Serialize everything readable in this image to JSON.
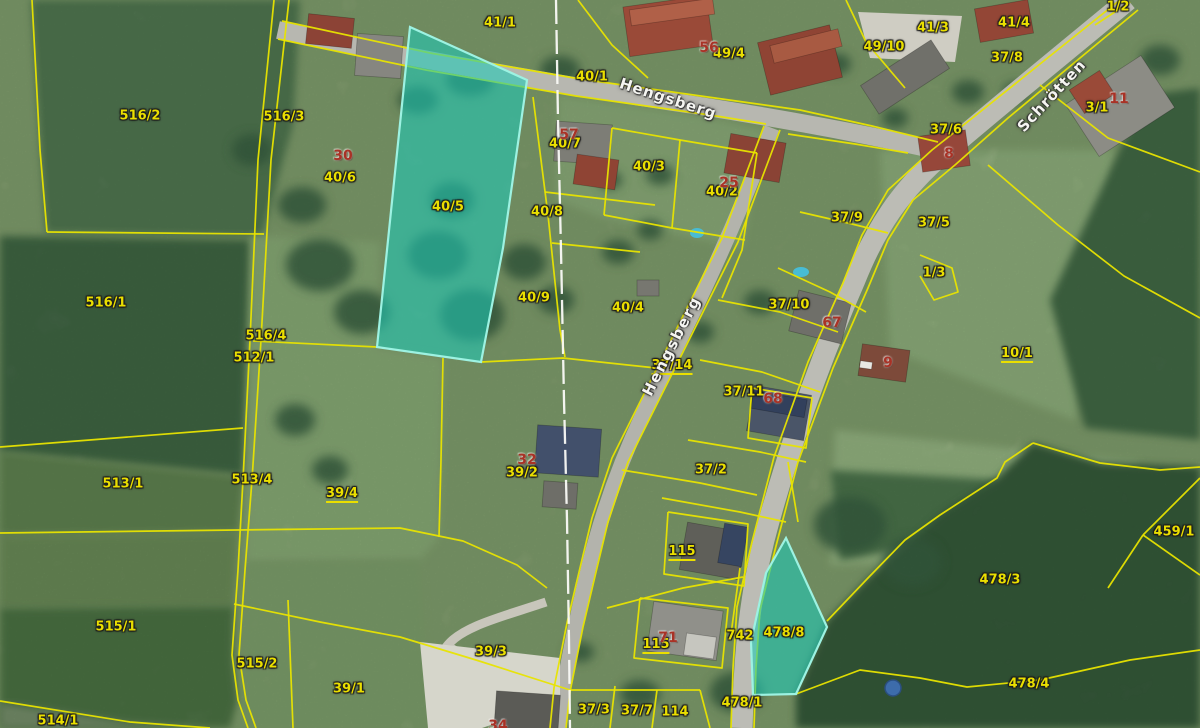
{
  "map": {
    "colors": {
      "parcel_line": "#e8e400",
      "parcel_label": "#eadf00",
      "house_number_label": "#a93226",
      "street_label": "#f5f5f1",
      "highlight_fill": "#1ec9b6",
      "highlight_border": "#9df2e2",
      "municipal_boundary": "#fafaf7"
    },
    "street_labels": [
      {
        "name": "Hengsberg",
        "x": 668,
        "y": 99,
        "rotation": 18,
        "spacing": 1
      },
      {
        "name": "Hengsberg",
        "x": 672,
        "y": 346,
        "rotation": -63,
        "spacing": 2
      },
      {
        "name": "Schrötten",
        "x": 1052,
        "y": 96,
        "rotation": -47,
        "spacing": 1
      }
    ],
    "highlighted_parcels": [
      {
        "id": "40/5",
        "points": "410,27 527,80 503,248 481,362 377,347"
      },
      {
        "id": "478/8",
        "points": "786,538 766,573 751,642 753,695 796,694 827,627"
      }
    ],
    "parcel_labels": [
      {
        "text": "516/2",
        "x": 140,
        "y": 116
      },
      {
        "text": "516/3",
        "x": 284,
        "y": 117
      },
      {
        "text": "40/6",
        "x": 340,
        "y": 178
      },
      {
        "text": "516/1",
        "x": 106,
        "y": 303
      },
      {
        "text": "516/4",
        "x": 266,
        "y": 336
      },
      {
        "text": "512/1",
        "x": 254,
        "y": 358
      },
      {
        "text": "513/1",
        "x": 123,
        "y": 484
      },
      {
        "text": "513/4",
        "x": 252,
        "y": 480
      },
      {
        "text": "39/4",
        "x": 342,
        "y": 495,
        "underline": true
      },
      {
        "text": "515/1",
        "x": 116,
        "y": 627
      },
      {
        "text": "515/2",
        "x": 257,
        "y": 664
      },
      {
        "text": "39/1",
        "x": 349,
        "y": 689
      },
      {
        "text": "514/1",
        "x": 58,
        "y": 721
      },
      {
        "text": "41/1",
        "x": 500,
        "y": 23
      },
      {
        "text": "40/1",
        "x": 592,
        "y": 77
      },
      {
        "text": "40/7",
        "x": 565,
        "y": 144
      },
      {
        "text": "40/3",
        "x": 649,
        "y": 167
      },
      {
        "text": "40/2",
        "x": 722,
        "y": 192
      },
      {
        "text": "40/8",
        "x": 547,
        "y": 212
      },
      {
        "text": "40/5",
        "x": 448,
        "y": 207
      },
      {
        "text": "40/9",
        "x": 534,
        "y": 298
      },
      {
        "text": "40/4",
        "x": 628,
        "y": 308
      },
      {
        "text": "49/4",
        "x": 729,
        "y": 54
      },
      {
        "text": "49/10",
        "x": 884,
        "y": 47
      },
      {
        "text": "41/3",
        "x": 933,
        "y": 28
      },
      {
        "text": "41/4",
        "x": 1014,
        "y": 23
      },
      {
        "text": "1/2",
        "x": 1118,
        "y": 7
      },
      {
        "text": "37/8",
        "x": 1007,
        "y": 58
      },
      {
        "text": "37/6",
        "x": 946,
        "y": 130
      },
      {
        "text": "3/1",
        "x": 1097,
        "y": 108
      },
      {
        "text": "37/9",
        "x": 847,
        "y": 218
      },
      {
        "text": "37/5",
        "x": 934,
        "y": 223
      },
      {
        "text": "1/3",
        "x": 934,
        "y": 273
      },
      {
        "text": "37/10",
        "x": 789,
        "y": 305
      },
      {
        "text": "10/1",
        "x": 1017,
        "y": 355,
        "underline": true
      },
      {
        "text": "37/14",
        "x": 672,
        "y": 367,
        "underline": true
      },
      {
        "text": "37/11",
        "x": 744,
        "y": 392
      },
      {
        "text": "37/2",
        "x": 711,
        "y": 470
      },
      {
        "text": "39/2",
        "x": 522,
        "y": 473
      },
      {
        "text": "39/3",
        "x": 491,
        "y": 652
      },
      {
        "text": "115",
        "x": 682,
        "y": 553,
        "underline": true
      },
      {
        "text": "115",
        "x": 656,
        "y": 646,
        "underline": true
      },
      {
        "text": "742",
        "x": 740,
        "y": 636
      },
      {
        "text": "478/8",
        "x": 784,
        "y": 633
      },
      {
        "text": "478/1",
        "x": 742,
        "y": 703
      },
      {
        "text": "114",
        "x": 675,
        "y": 712
      },
      {
        "text": "37/7",
        "x": 637,
        "y": 711
      },
      {
        "text": "37/3",
        "x": 594,
        "y": 710
      },
      {
        "text": "478/3",
        "x": 1000,
        "y": 580
      },
      {
        "text": "478/4",
        "x": 1029,
        "y": 684
      },
      {
        "text": "459/1",
        "x": 1174,
        "y": 532
      }
    ],
    "house_number_labels": [
      {
        "text": "30",
        "x": 343,
        "y": 156
      },
      {
        "text": "56",
        "x": 709,
        "y": 48
      },
      {
        "text": "57",
        "x": 569,
        "y": 135
      },
      {
        "text": "25",
        "x": 729,
        "y": 183
      },
      {
        "text": "8",
        "x": 949,
        "y": 154
      },
      {
        "text": "11",
        "x": 1119,
        "y": 99
      },
      {
        "text": "67",
        "x": 832,
        "y": 323
      },
      {
        "text": "9",
        "x": 888,
        "y": 363
      },
      {
        "text": "68",
        "x": 773,
        "y": 399
      },
      {
        "text": "32",
        "x": 527,
        "y": 460
      },
      {
        "text": "71",
        "x": 668,
        "y": 638
      },
      {
        "text": "34",
        "x": 498,
        "y": 726
      }
    ]
  }
}
